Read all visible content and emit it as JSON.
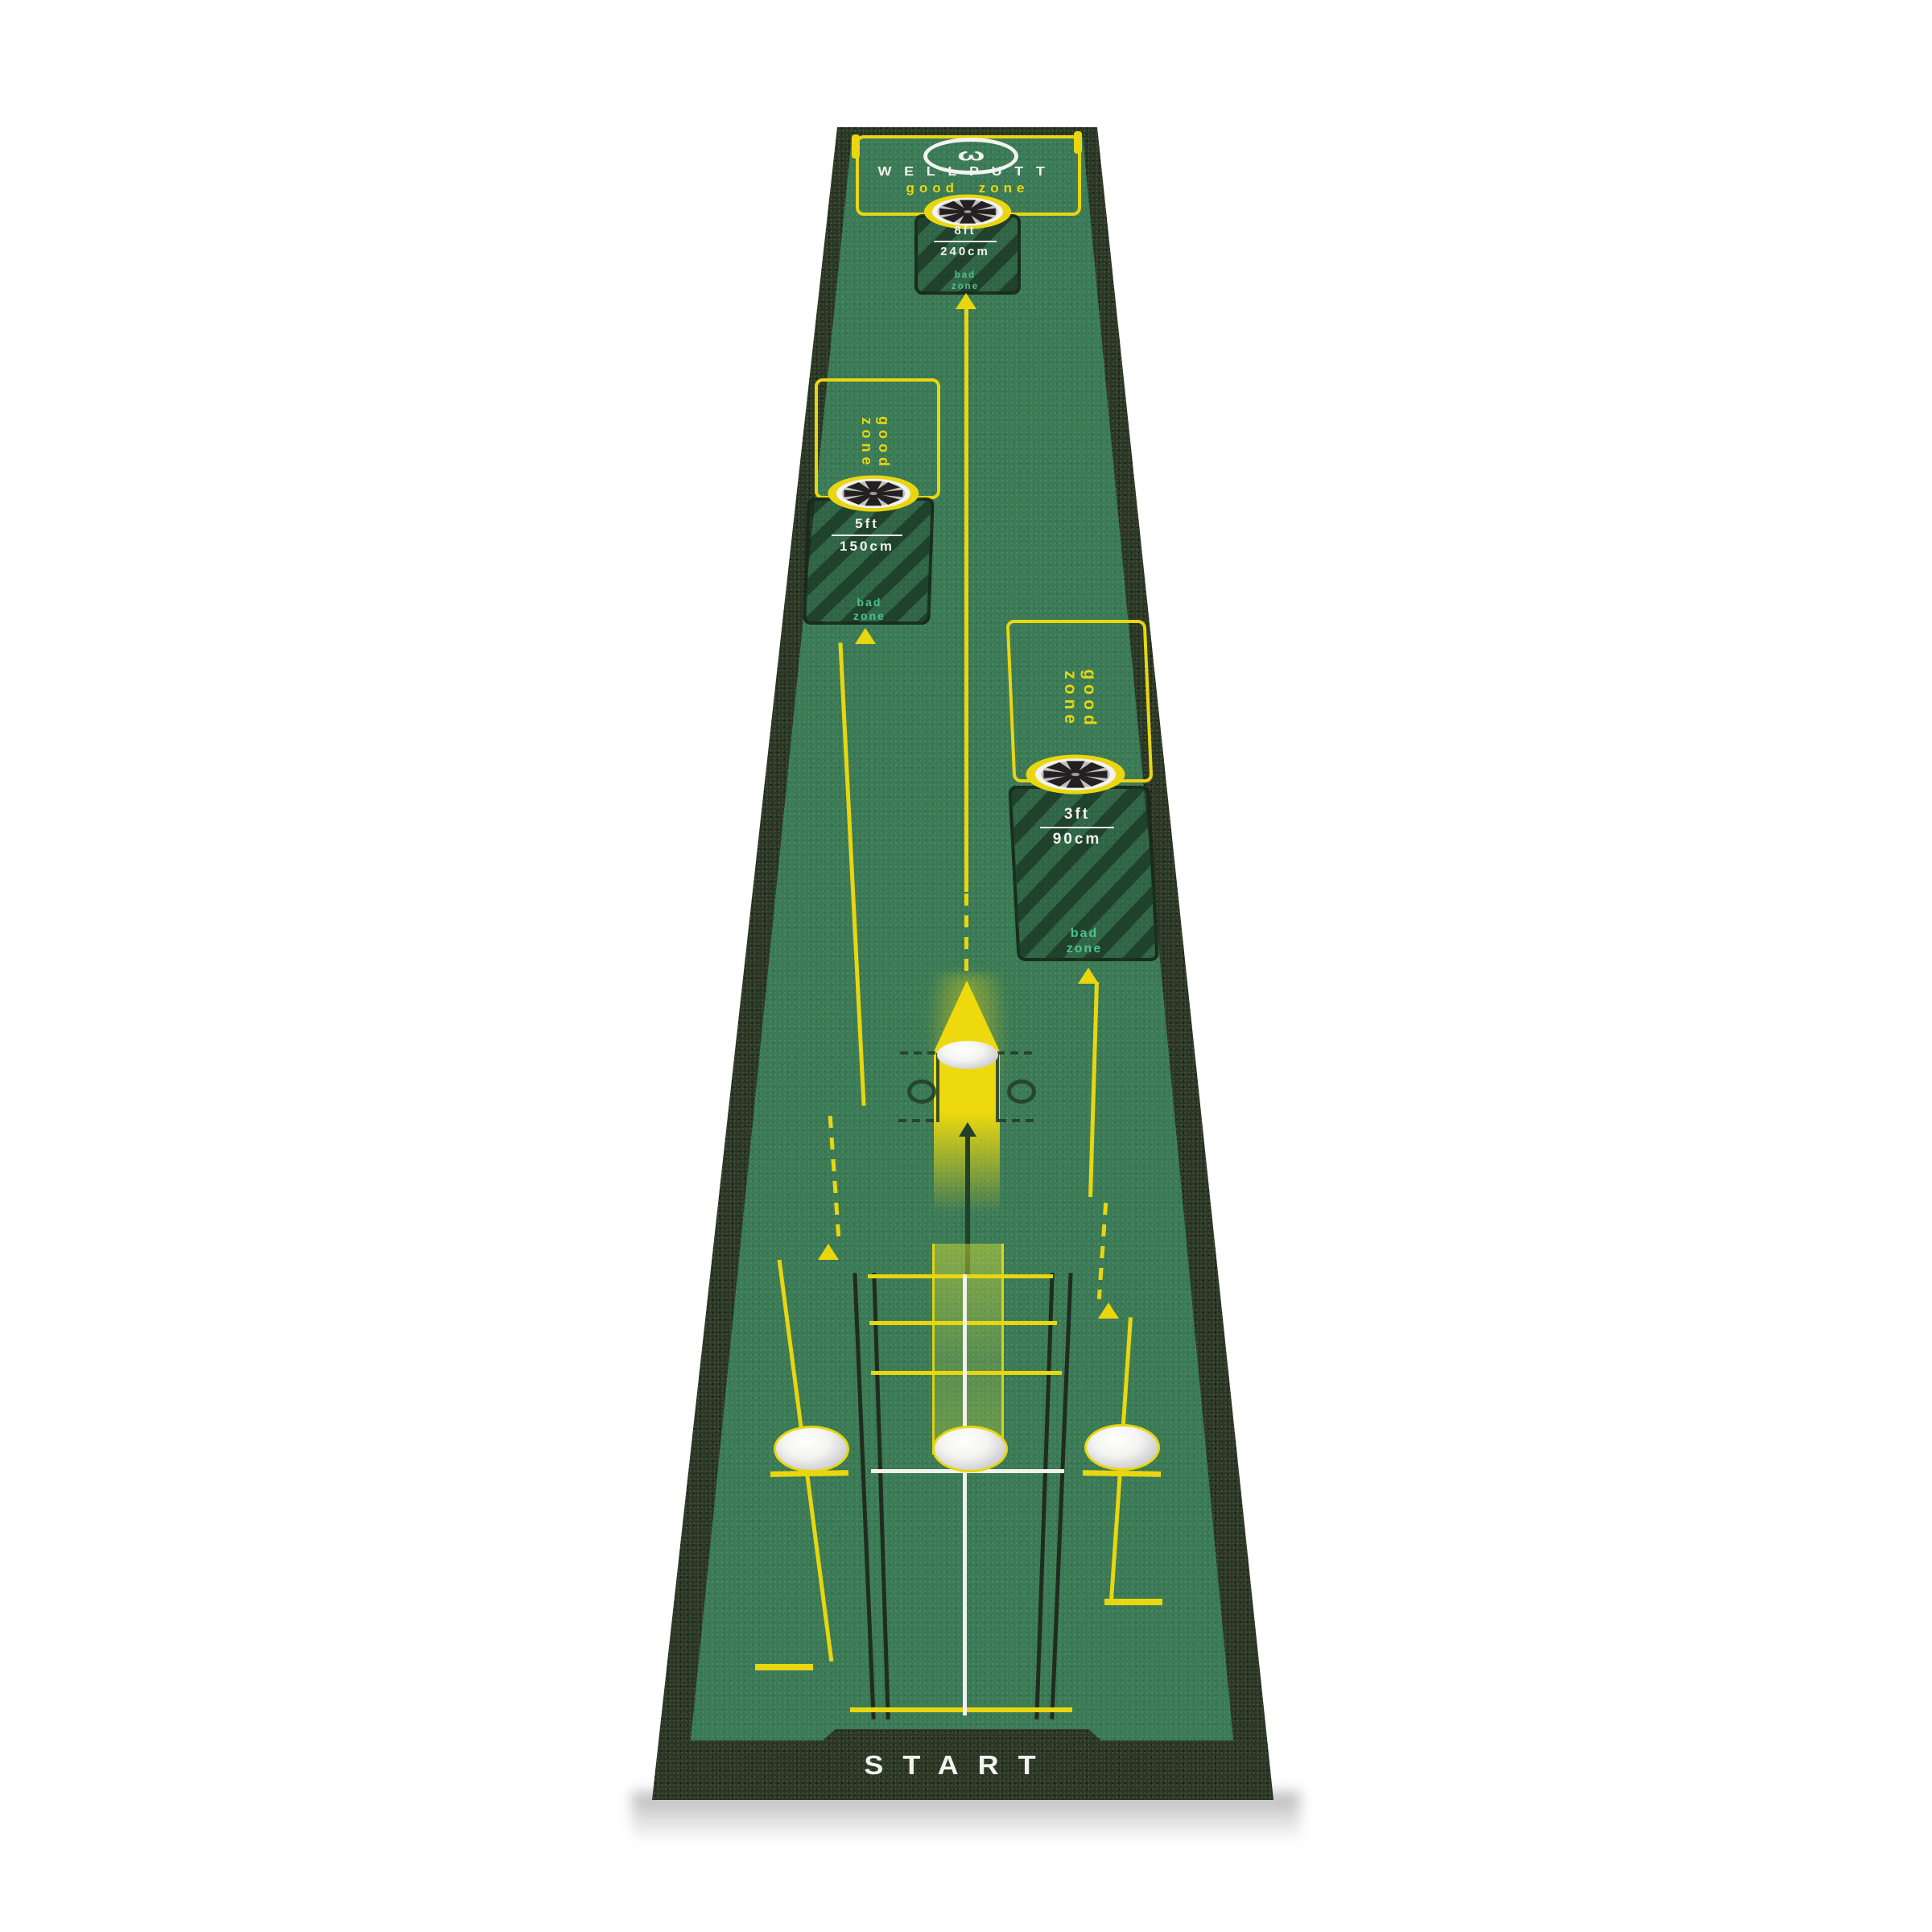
{
  "brand": {
    "name": "WELLPUTT",
    "logo_glyph": "ω"
  },
  "labels": {
    "start": "START",
    "good_zone": "good zone",
    "bad_zone": "bad\nzone"
  },
  "targets": {
    "far": {
      "feet": "8ft",
      "cm": "240cm"
    },
    "mid": {
      "feet": "5ft",
      "cm": "150cm"
    },
    "near": {
      "feet": "3ft",
      "cm": "90cm"
    }
  },
  "colors": {
    "mat_green": "#3b7b56",
    "border_dark": "#2b3725",
    "accent_yellow": "#e9d60f",
    "bad_zone_teal": "#4ec18d",
    "text_white": "#f2f2ef"
  }
}
